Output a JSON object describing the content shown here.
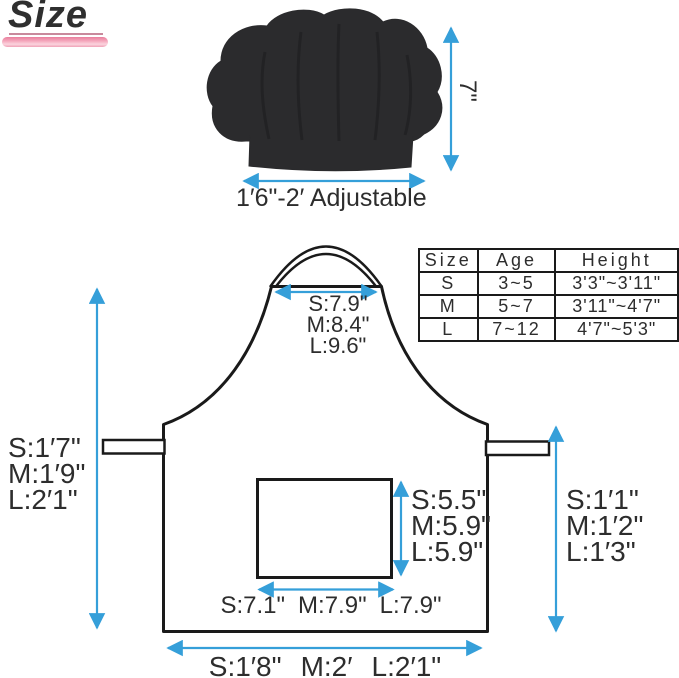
{
  "title": "Size",
  "hat": {
    "height_label": "7\"",
    "width_label": "1′6\"-2′ Adjustable"
  },
  "size_table": {
    "headers": [
      "Size",
      "Age",
      "Height"
    ],
    "rows": [
      [
        "S",
        "3~5",
        "3'3\"~3'11\""
      ],
      [
        "M",
        "5~7",
        "3'11\"~4'7\""
      ],
      [
        "L",
        "7~12",
        "4'7\"~5'3\""
      ]
    ]
  },
  "apron": {
    "neck_width": [
      "S:7.9\"",
      "M:8.4\"",
      "L:9.6\""
    ],
    "bib_height": [
      "S:1′7\"",
      "M:1′9\"",
      "L:2′1\""
    ],
    "skirt_height": [
      "S:1′1\"",
      "M:1′2\"",
      "L:1′3\""
    ],
    "pocket_height": [
      "S:5.5\"",
      "M:5.9\"",
      "L:5.9\""
    ],
    "pocket_width": [
      "S:7.1\"",
      "M:7.9\"",
      "L:7.9\""
    ],
    "bottom_width": [
      "S:1′8\"",
      "M:2′",
      "L:2′1\""
    ]
  },
  "colors": {
    "arrow_blue": "#359fd9",
    "outline_black": "#1a1a1a",
    "hat_fill": "#2b2b2d",
    "accent_pink": "#f0a2b8",
    "text": "#2d2d2d"
  }
}
